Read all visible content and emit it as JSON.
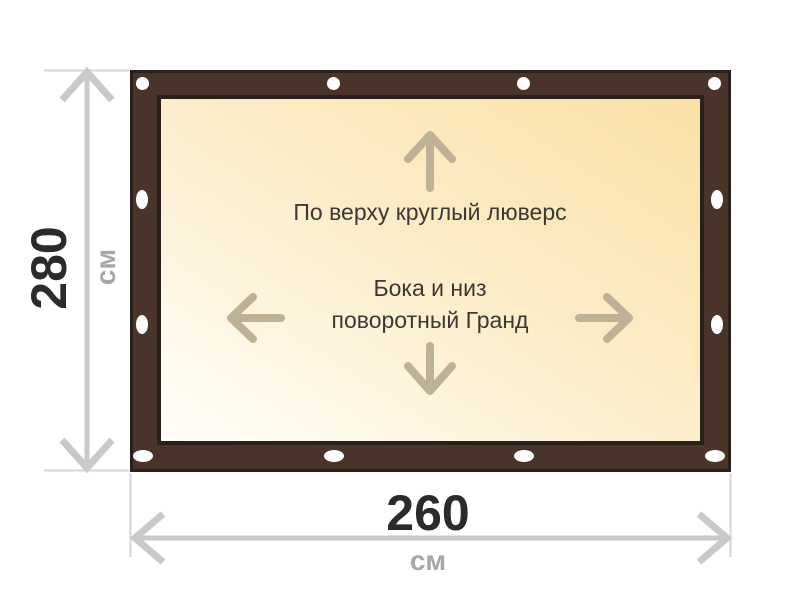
{
  "colors": {
    "page-bg": "#ffffff",
    "frame-brown": "#4a3429",
    "frame-outline": "#28211b",
    "panel-light": "#fffef9",
    "panel-mid": "#fcecc6",
    "panel-peach": "#fae0a6",
    "grommet-white": "#ffffff",
    "interior-arrow": "#bfb195",
    "dim-line": "#c9c9c9",
    "dim-ext": "#d6d6d6",
    "value-text": "#2b2b2b",
    "unit-text": "#a6a6a6",
    "label-text": "#3b3835"
  },
  "banner": {
    "top_label": "По верху круглый люверс",
    "middle_label_line1": "Бока и низ",
    "middle_label_line2": "поворотный Гранд",
    "grommet_icon": "round-eyelet",
    "direction_arrow_icons": [
      "arrow-up",
      "arrow-left",
      "arrow-right",
      "arrow-down"
    ],
    "grommet_counts": {
      "top": 4,
      "bottom": 4,
      "left": 2,
      "right": 2
    }
  },
  "dimensions": {
    "height_value": "280",
    "height_unit": "см",
    "width_value": "260",
    "width_unit": "см"
  }
}
